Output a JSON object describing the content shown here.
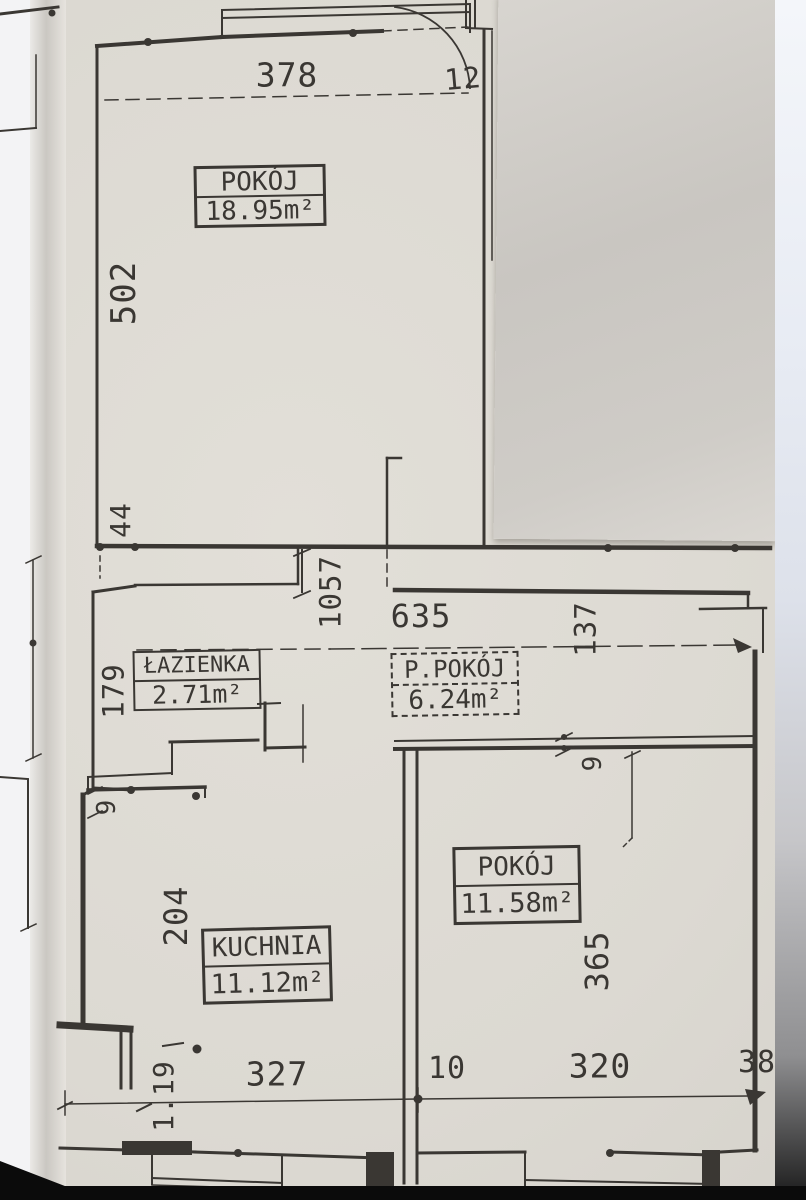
{
  "colors": {
    "ink": "#3a3733",
    "paper": "#dedbd4",
    "overlay": "#cdcac5",
    "bg-left": "#f3f3f5",
    "bg-right": "#e9edf4",
    "photo-black": "#0b0b0b"
  },
  "rooms": [
    {
      "name": "POKÓJ",
      "area": "18.95m²"
    },
    {
      "name": "ŁAZIENKA",
      "area": "2.71m²"
    },
    {
      "name": "P.POKÓJ",
      "area": "6.24m²"
    },
    {
      "name": "KUCHNIA",
      "area": "11.12m²"
    },
    {
      "name": "POKÓJ",
      "area": "11.58m²"
    }
  ],
  "dimensions": {
    "top_width": "378",
    "top_door": "12",
    "left_height": "502",
    "left_offset": "44",
    "hall_depth": "1057",
    "corridor_width": "635",
    "corridor_right": "137",
    "bathroom_height": "179",
    "bathroom_offset": "9",
    "kitchen_offset": "9",
    "kitchen_height": "204",
    "room2_offset": "9",
    "room2_height": "365",
    "bottom_left_wall": "1.19",
    "kitchen_width": "327",
    "wall_thickness": "10",
    "room2_width": "320",
    "right_offset": "38"
  }
}
